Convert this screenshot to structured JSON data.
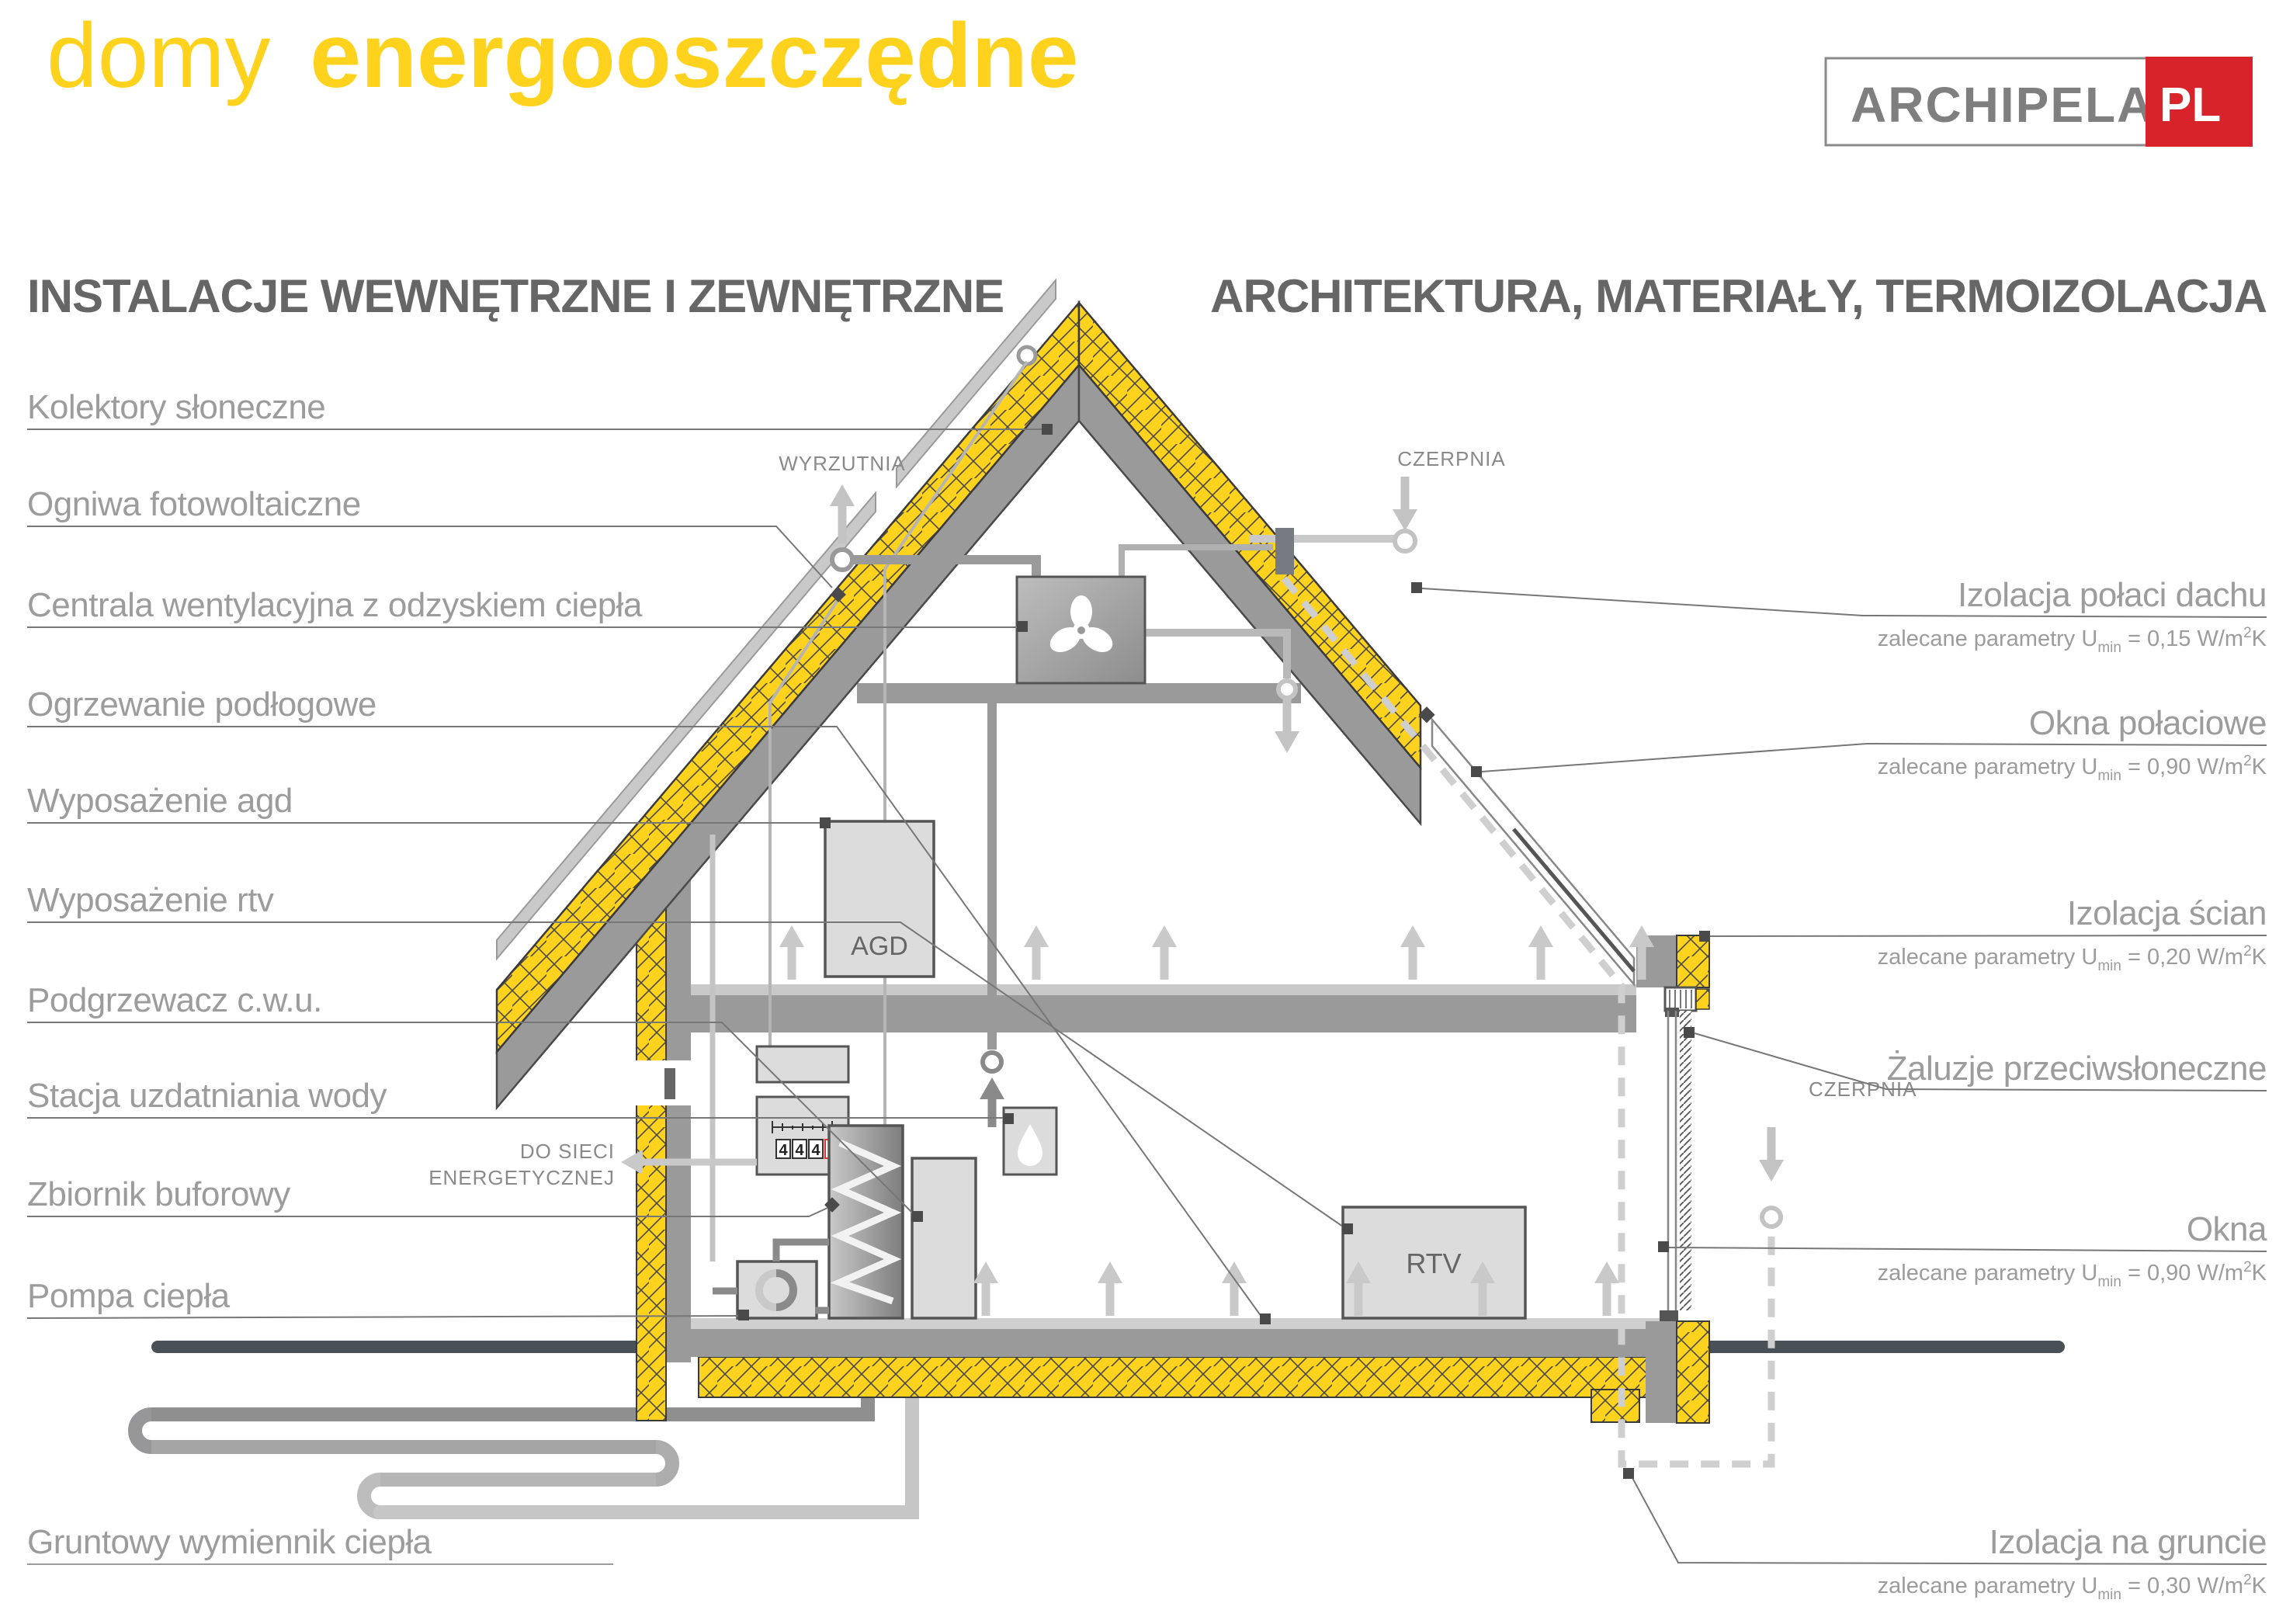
{
  "title": {
    "light": "domy",
    "bold": "energooszczędne"
  },
  "logo": {
    "name": "ARCHIPELAG",
    "tld": "PL"
  },
  "headers": {
    "left": "INSTALACJE WEWNĘTRZNE I ZEWNĘTRZNE",
    "right": "ARCHITEKTURA, MATERIAŁY, TERMOIZOLACJA"
  },
  "left_labels": [
    {
      "label": "Kolektory słoneczne"
    },
    {
      "label": "Ogniwa fotowoltaiczne"
    },
    {
      "label": "Centrala wentylacyjna z odzyskiem ciepła"
    },
    {
      "label": "Ogrzewanie podłogowe"
    },
    {
      "label": "Wyposażenie agd"
    },
    {
      "label": "Wyposażenie rtv"
    },
    {
      "label": "Podgrzewacz c.w.u."
    },
    {
      "label": "Stacja uzdatniania wody"
    },
    {
      "label": "Zbiornik buforowy"
    },
    {
      "label": "Pompa ciepła"
    },
    {
      "label": "Gruntowy wymiennik ciepła"
    }
  ],
  "right_labels": [
    {
      "label": "Izolacja połaci dachu",
      "param": {
        "pre": "zalecane parametry U",
        "sub": "min",
        "mid": " = 0,15 W/m",
        "sup": "2",
        "post": "K"
      }
    },
    {
      "label": "Okna połaciowe",
      "param": {
        "pre": "zalecane parametry U",
        "sub": "min",
        "mid": " = 0,90 W/m",
        "sup": "2",
        "post": "K"
      }
    },
    {
      "label": "Izolacja ścian",
      "param": {
        "pre": "zalecane parametry U",
        "sub": "min",
        "mid": " = 0,20 W/m",
        "sup": "2",
        "post": "K"
      }
    },
    {
      "label": "Żaluzje przeciwsłoneczne",
      "param": null
    },
    {
      "label": "Okna",
      "param": {
        "pre": "zalecane parametry U",
        "sub": "min",
        "mid": " = 0,90 W/m",
        "sup": "2",
        "post": "K"
      }
    },
    {
      "label": "Izolacja na gruncie",
      "param": {
        "pre": "zalecane parametry U",
        "sub": "min",
        "mid": " = 0,30 W/m",
        "sup": "2",
        "post": "K"
      }
    }
  ],
  "annotations": {
    "wyrzutnia": "WYRZUTNIA",
    "czerpnia_roof": "CZERPNIA",
    "czerpnia_ground": "CZERPNIA",
    "grid_line1": "DO SIECI",
    "grid_line2": "ENERGETYCZNEJ"
  },
  "equipment": {
    "agd": "AGD",
    "rtv": "RTV"
  },
  "meter": {
    "digits": [
      "4",
      "4",
      "4",
      "4"
    ]
  },
  "colors": {
    "accent_yellow": "#ffd21e",
    "logo_red": "#d8232a",
    "meter_red": "#e03131",
    "structure_gray": "#9a9a9a",
    "dark_slate": "#495056",
    "label_gray": "#9c9c9c"
  }
}
